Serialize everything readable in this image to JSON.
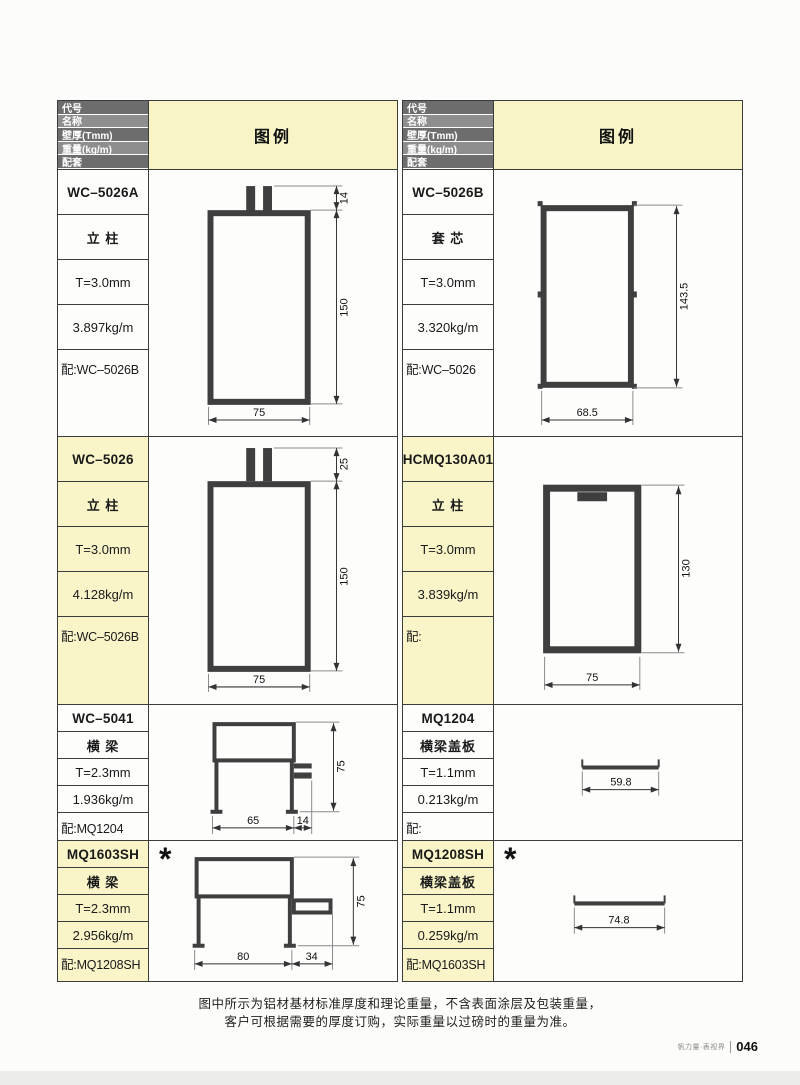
{
  "header": {
    "rows": [
      "代号",
      "名称",
      "壁厚(Tmm)",
      "重量(kg/m)",
      "配套"
    ],
    "legend": "图例"
  },
  "profiles": [
    {
      "code": "WC–5026A",
      "name": "立 柱",
      "thickness": "T=3.0mm",
      "weight": "3.897kg/m",
      "match": "配:WC–5026B",
      "dims": {
        "tab": "14",
        "height": "150",
        "width": "75"
      }
    },
    {
      "code": "WC–5026",
      "name": "立 柱",
      "thickness": "T=3.0mm",
      "weight": "4.128kg/m",
      "match": "配:WC–5026B",
      "dims": {
        "tab": "25",
        "height": "150",
        "width": "75"
      }
    },
    {
      "code": "WC–5041",
      "name": "横 梁",
      "thickness": "T=2.3mm",
      "weight": "1.936kg/m",
      "match": "配:MQ1204",
      "dims": {
        "height": "75",
        "width_body": "65",
        "width_fin": "14"
      }
    },
    {
      "code": "MQ1603SH",
      "name": "横 梁",
      "thickness": "T=2.3mm",
      "weight": "2.956kg/m",
      "match": "配:MQ1208SH",
      "star": "*",
      "dims": {
        "height": "75",
        "width_body": "80",
        "width_fin": "34"
      }
    },
    {
      "code": "WC–5026B",
      "name": "套 芯",
      "thickness": "T=3.0mm",
      "weight": "3.320kg/m",
      "match": "配:WC–5026",
      "dims": {
        "height": "143.5",
        "width": "68.5"
      }
    },
    {
      "code": "HCMQ130A01",
      "name": "立 柱",
      "thickness": "T=3.0mm",
      "weight": "3.839kg/m",
      "match": "配:",
      "dims": {
        "height": "130",
        "width": "75"
      }
    },
    {
      "code": "MQ1204",
      "name": "横梁盖板",
      "thickness": "T=1.1mm",
      "weight": "0.213kg/m",
      "match": "配:",
      "dims": {
        "width": "59.8"
      }
    },
    {
      "code": "MQ1208SH",
      "name": "横梁盖板",
      "thickness": "T=1.1mm",
      "weight": "0.259kg/m",
      "match": "配:MQ1603SH",
      "star": "*",
      "dims": {
        "width": "74.8"
      }
    }
  ],
  "footer": {
    "note_line1": "图中所示为铝材基材标准厚度和理论重量，不含表面涂层及包装重量，",
    "note_line2": "客户可根据需要的厚度订购，实际重量以过磅时的重量为准。",
    "brand": "帆力量·表视界",
    "page_number": "046"
  },
  "colors": {
    "legend_bg": "#f8f4c6",
    "row_highlight_bg": "#f9f5c9",
    "header_row_dark": "#6d6d6d",
    "header_row_light": "#8e8e8e",
    "line": "#3c3c3c",
    "drawing_stroke": "#3f3f3f"
  }
}
